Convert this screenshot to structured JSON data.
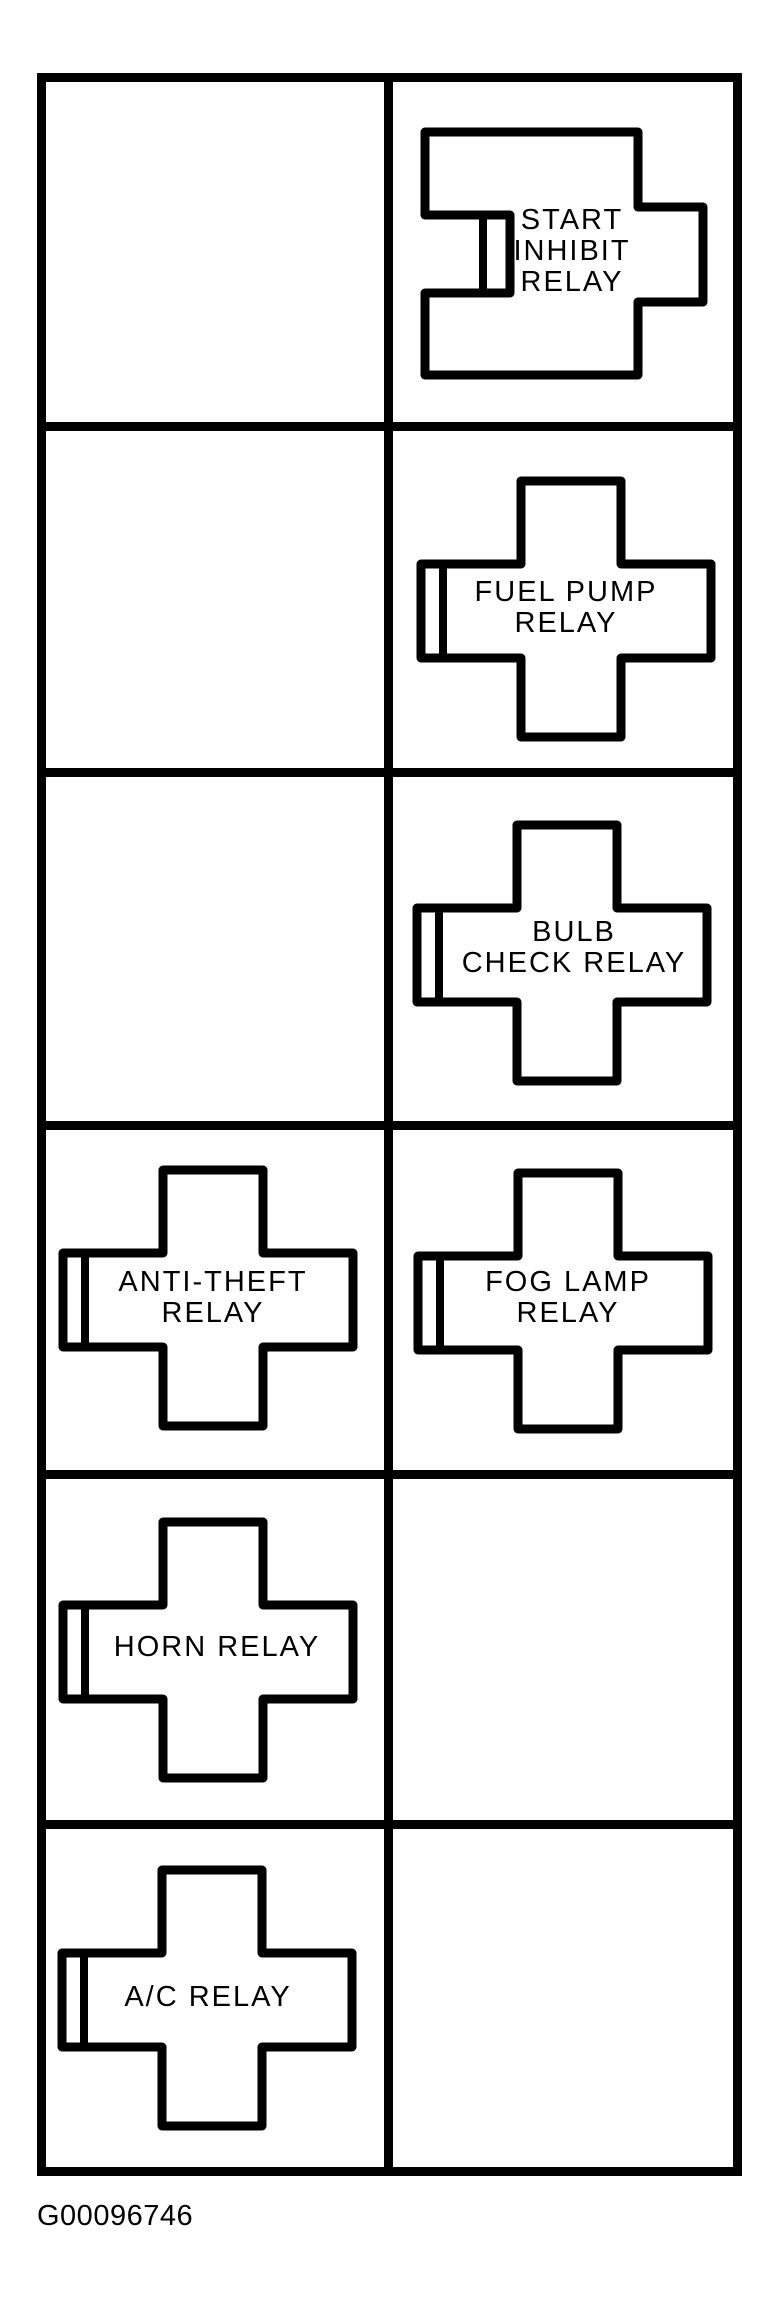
{
  "figure": {
    "caption": "G00096746",
    "background_color": "#ffffff",
    "line_color": "#000000",
    "description": "Relay box identification diagram, 6 rows by 2 columns"
  },
  "grid": {
    "rows": 6,
    "columns": 2
  },
  "relays": [
    {
      "id": "start-inhibit-relay",
      "label": "START INHIBIT RELAY",
      "lines": [
        "START",
        "INHIBIT",
        "RELAY"
      ],
      "row": 1,
      "column": "right",
      "shape": "notched-rectangle"
    },
    {
      "id": "fuel-pump-relay",
      "label": "FUEL PUMP RELAY",
      "lines": [
        "FUEL PUMP",
        "RELAY"
      ],
      "row": 2,
      "column": "right",
      "shape": "cross"
    },
    {
      "id": "bulb-check-relay",
      "label": "BULB CHECK RELAY",
      "lines": [
        "BULB",
        "CHECK RELAY"
      ],
      "row": 3,
      "column": "right",
      "shape": "cross"
    },
    {
      "id": "anti-theft-relay",
      "label": "ANTI-THEFT RELAY",
      "lines": [
        "ANTI-THEFT",
        "RELAY"
      ],
      "row": 4,
      "column": "left",
      "shape": "cross"
    },
    {
      "id": "fog-lamp-relay",
      "label": "FOG LAMP RELAY",
      "lines": [
        "FOG LAMP",
        "RELAY"
      ],
      "row": 4,
      "column": "right",
      "shape": "cross"
    },
    {
      "id": "horn-relay",
      "label": "HORN RELAY",
      "lines": [
        "HORN RELAY"
      ],
      "row": 5,
      "column": "left",
      "shape": "cross"
    },
    {
      "id": "ac-relay",
      "label": "A/C RELAY",
      "lines": [
        "A/C RELAY"
      ],
      "row": 6,
      "column": "left",
      "shape": "cross"
    }
  ]
}
